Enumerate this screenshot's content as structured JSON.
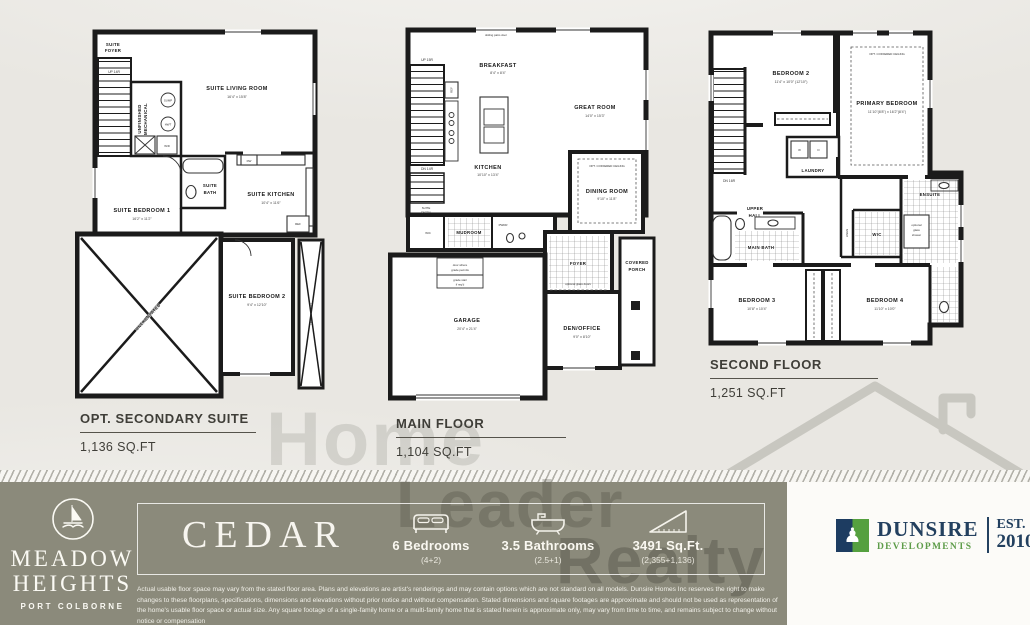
{
  "watermark": {
    "word1": "Home",
    "word2": "Leader",
    "word3": "Realty"
  },
  "plans": {
    "p1": {
      "title": "OPT. SECONDARY SUITE",
      "sqft": "1,136 SQ.FT",
      "foyer1": "SUITE",
      "foyer2": "FOYER",
      "up": "UP 14R",
      "mech1": "UNFINISHED",
      "mech2": "MECHANICAL",
      "sump": "SUMP",
      "hwt": "HWT",
      "living": "SUITE LIVING ROOM",
      "living_dims": "16'4\" x 15'8\"",
      "bath1": "SUITE",
      "bath2": "BATH",
      "bed1": "SUITE BEDROOM 1",
      "bed1_dims": "16'2\" x 11'2\"",
      "kitchen": "SUITE KITCHEN",
      "kitchen_dims": "10'4\" x 11'6\"",
      "dw": "DW",
      "ref": "REF",
      "wd": "W/D",
      "bed2": "SUITE BEDROOM 2",
      "bed2_dims": "9'4\" x 12'10\"",
      "unexcavated": "UNEXCAVATED",
      "unexcavated2": "UNEXCAVATED"
    },
    "p2": {
      "title": "MAIN FLOOR",
      "sqft": "1,104 SQ.FT",
      "patio": "sliding patio door",
      "breakfast": "BREAKFAST",
      "breakfast_dims": "8'4\" x 8'4\"",
      "great": "GREAT ROOM",
      "great_dims": "14'0\" x 15'3\"",
      "kitchen": "KITCHEN",
      "kitchen_dims": "10'10\" x 13'4\"",
      "ref": "REF",
      "up": "UP 15R",
      "dn": "DN 14R",
      "entry1": "SUITE",
      "entry2": "ENTRY",
      "mudroom": "MUDROOM",
      "wic": "WIC",
      "pwdr": "PWDR",
      "dining": "DINING ROOM",
      "dining_dims": "9'10\" x 11'8\"",
      "coffered": "OPT. COFFERED CEILING",
      "foyer": "FOYER",
      "glass_doors": "optional glass doors",
      "den": "DEN/OFFICE",
      "den_dims": "9'0\" x 8'10\"",
      "porch1": "COVERED",
      "porch2": "PORCH",
      "garage": "GARAGE",
      "garage_dims": "20'4\" x 21'4\"",
      "note1": "door where",
      "note2": "grade permits",
      "note3": "grade stair",
      "note4": "if req'd"
    },
    "p3": {
      "title": "SECOND FLOOR",
      "sqft": "1,251 SQ.FT",
      "bed2": "BEDROOM 2",
      "bed2_dims": "11'4\" x 10'0\" (12'10\")",
      "primary": "PRIMARY BEDROOM",
      "primary_dims": "11'10\"(8'8\") x 16'2\"(8'4\")",
      "coffered": "OPT. COFFERED CEILING",
      "laundry": "LAUNDRY",
      "w": "W",
      "d": "D",
      "upper1": "UPPER",
      "upper2": "HALL",
      "dn": "DN 16R",
      "main_bath": "MAIN BATH",
      "linen": "LINEN",
      "wic": "WIC",
      "ensuite": "ENSUITE",
      "shower1": "optional",
      "shower2": "glass",
      "shower3": "shower",
      "bed3": "BEDROOM 3",
      "bed3_dims": "10'8\" x 10'4\"",
      "bed4": "BEDROOM 4",
      "bed4_dims": "11'10\" x 10'0\""
    }
  },
  "footer": {
    "brand": {
      "line1": "MEADOW",
      "line2": "HEIGHTS",
      "location": "PORT COLBORNE"
    },
    "model_name": "CEDAR",
    "stats": [
      {
        "icon": "bed-icon",
        "label": "6 Bedrooms",
        "sub": "(4+2)"
      },
      {
        "icon": "bathtub-icon",
        "label": "3.5 Bathrooms",
        "sub": "(2.5+1)"
      },
      {
        "icon": "area-ruler-icon",
        "label": "3491 Sq.Ft.",
        "sub": "(2,355+1,136)"
      }
    ],
    "disclaimer": "Actual usable floor space may vary from the stated floor area. Plans and elevations are artist's renderings and may contain options which are not standard on all models. Dunsire Homes Inc reserves the right to make changes to these floorplans, specifications, dimensions and elevations without prior notice and without compensation. Stated dimensions and square footages are approximate and should not be used as representation of the home's usable floor space or actual size. Any square footage of a single-family home or a multi-family home that is stated herein is approximate only, may vary from time to time, and remains subject to change without notice or compensation",
    "developer": {
      "name": "DUNSIRE",
      "division": "DEVELOPMENTS",
      "est": "EST.",
      "year": "2010"
    }
  },
  "colors": {
    "footer_bar": "#8b8a7b",
    "dunsire_navy": "#23405f",
    "dunsire_green": "#55a03f"
  }
}
